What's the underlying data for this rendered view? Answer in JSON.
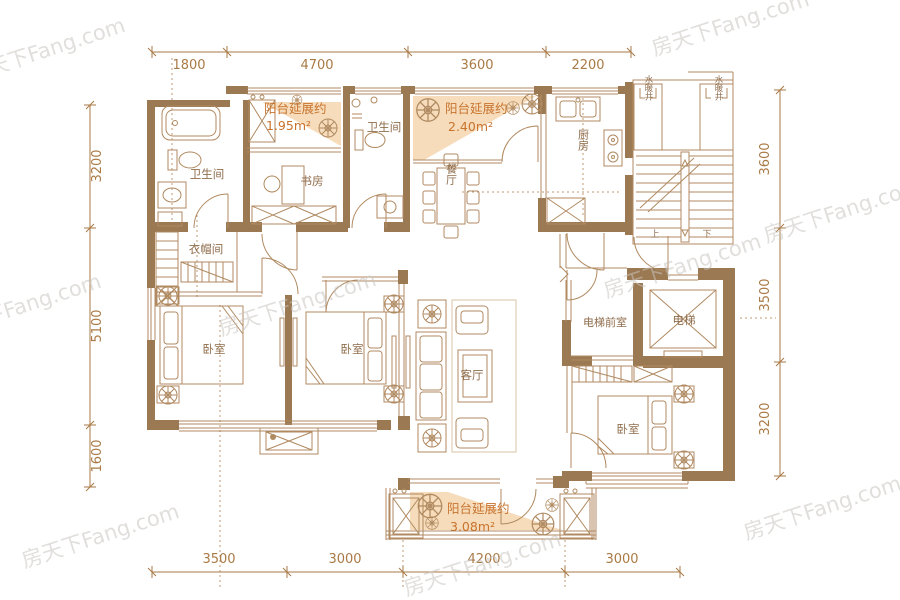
{
  "watermark_text": "房天下Fang.com",
  "dimensions": {
    "top": [
      "1800",
      "4700",
      "3600",
      "2200"
    ],
    "bottom": [
      "3500",
      "3000",
      "4200",
      "3000"
    ],
    "left": [
      "3200",
      "5100",
      "1600"
    ],
    "right": [
      "3600",
      "3500",
      "3200"
    ]
  },
  "rooms": {
    "bathroom_left": "卫生间",
    "study": "书房",
    "bathroom_middle": "卫生间",
    "dining": "餐厅",
    "kitchen": "厨房",
    "shaft_left": "水暖井",
    "shaft_right": "水暖井",
    "stairs_up": "上",
    "stairs_down": "下",
    "closet": "衣帽间",
    "bedroom_left": "卧室",
    "bedroom_middle": "卧室",
    "living": "客厅",
    "elevator_lobby": "电梯前室",
    "elevator": "电梯",
    "bedroom_right": "卧室"
  },
  "balconies": {
    "top_left": {
      "label": "阳台延展约",
      "area": "1.95m²"
    },
    "top_middle": {
      "label": "阳台延展约",
      "area": "2.40m²"
    },
    "bottom": {
      "label": "阳台延展约",
      "area": "3.08m²"
    }
  },
  "colors": {
    "wall": "#9b7953",
    "line": "#b08a61",
    "lite": "#d8c3a6",
    "dim": "#aa7a46",
    "label": "#8f6d4c",
    "accent": "#c8732e",
    "peach": "#f6dcba",
    "wmk": "#c9c5c1"
  }
}
